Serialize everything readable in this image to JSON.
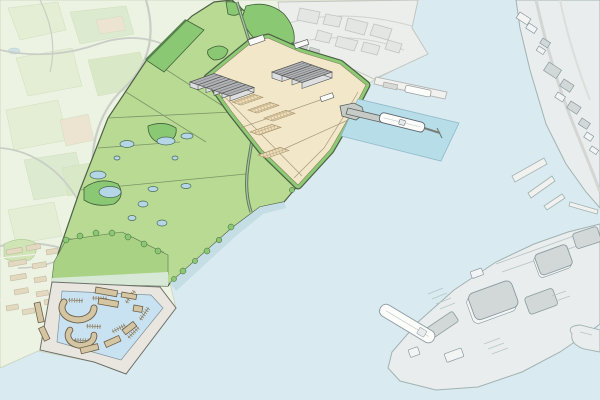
{
  "scene": {
    "description": "Illustrated aerial masterplan map of a coastal port development: green fields with ponds and hedgerows, a beige industrial quay platform with warehouse halls and hatched storage yards, a jetty with a moored ship in a highlighted dredged basin, a marina with pontoons, and greyed-out context (town, city and an existing port peninsula across the water). No text labels are rendered.",
    "features": {
      "warehouse_halls_west_cluster": 5,
      "warehouse_halls_east_cluster": 3,
      "storage_yards_hatched": 5,
      "field_ponds": 12,
      "ships_moored": 3,
      "marina_pontoon_groups": 8,
      "marina_buildings": 11,
      "context_port_peninsula_buildings": 8
    }
  },
  "palette": {
    "water": "#d9eaf0",
    "dredged_basin": "#b7dde9",
    "marina_water": "#c8e2f1",
    "context_land": "#edf3e2",
    "context_field_a": "#e3eed4",
    "context_field_b": "#dcead0",
    "context_field_c": "#d9e9c8",
    "context_field_tan": "#ece4d1",
    "context_road": "#c9cec7",
    "town_building": "#e3d9c0",
    "town_building_stroke": "#c4b99d",
    "city_fill": "#eceeec",
    "city_stroke": "#c0c3c0",
    "city_block": "#e4e6e4",
    "site_green": "#b8da92",
    "site_band_green": "#a9d285",
    "site_pale_band": "#d7e9d6",
    "site_outline": "#4e6147",
    "wood_green": "#8bc873",
    "wood_outline": "#41613c",
    "hedge_green": "#57824e",
    "field_line": "#7d9468",
    "pond_fill": "#b4d6e6",
    "pond_stroke": "#4a6a58",
    "beach": "#c5dde4",
    "platform": "#f3e7c9",
    "platform_line": "#a89a7c",
    "border_green": "#8ccb74",
    "hatch_bg": "#eeddba",
    "hatch_line": "#b9a57e",
    "roof_gray": "#b2b3b6",
    "roof_line": "#77787c",
    "wall_gray": "#dddee0",
    "building_stroke": "#4f5450",
    "white_building": "#fafaf8",
    "jetty_gray": "#c7cbc7",
    "jetty_stroke": "#5a605a",
    "ship_white": "#fcfcfa",
    "ship_stroke": "#5c666e",
    "pier_fill": "#f1f1ef",
    "pier_stroke": "#b4b6b4",
    "port_land": "#e9eded",
    "port_stroke": "#a2b2b2",
    "port_roof": "#d2d8d8",
    "port_wall": "#f3f5f5",
    "port_building_stroke": "#8a9aa0",
    "port_detail": "#b9c5c5",
    "marina_quay": "#e9e6e0",
    "marina_stroke": "#70706a",
    "marina_building": "#d4c6a3",
    "marina_building_stroke": "#6e5f49",
    "pontoon": "#8d7b5d"
  }
}
